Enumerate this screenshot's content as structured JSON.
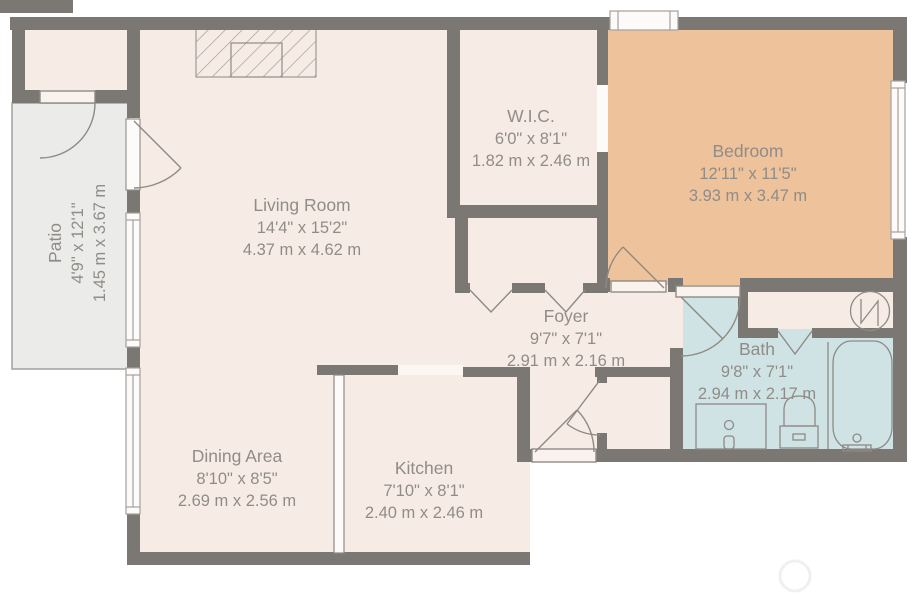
{
  "rooms": {
    "living": {
      "name": "Living Room",
      "imperial": "14'4\" x 15'2\"",
      "metric": "4.37 m x 4.62 m"
    },
    "wic": {
      "name": "W.I.C.",
      "imperial": "6'0\" x 8'1\"",
      "metric": "1.82 m x 2.46 m"
    },
    "bedroom": {
      "name": "Bedroom",
      "imperial": "12'11\" x 11'5\"",
      "metric": "3.93 m x 3.47 m"
    },
    "foyer": {
      "name": "Foyer",
      "imperial": "9'7\" x 7'1\"",
      "metric": "2.91 m x 2.16 m"
    },
    "bath": {
      "name": "Bath",
      "imperial": "9'8\" x 7'1\"",
      "metric": "2.94 m x 2.17 m"
    },
    "dining": {
      "name": "Dining Area",
      "imperial": "8'10\" x 8'5\"",
      "metric": "2.69 m x 2.56 m"
    },
    "kitchen": {
      "name": "Kitchen",
      "imperial": "7'10\" x 8'1\"",
      "metric": "2.40 m x 2.46 m"
    },
    "patio": {
      "name": "Patio",
      "imperial": "4'9\" x 12'1\"",
      "metric": "1.45 m x 3.67 m"
    }
  },
  "colors": {
    "wall": "#7b7772",
    "room_cream": "#f7ece5",
    "bedroom_fill": "#eec29b",
    "bath_fill": "#cfe3e5",
    "patio_fill": "#ebebe9",
    "line": "#8e8a85",
    "text": "#908c88",
    "window_fill": "#fcfbfa"
  },
  "icons": {
    "water_heater": "water-heater-icon",
    "bathtub": "bathtub-icon",
    "toilet": "toilet-icon",
    "sink_vanity": "sink-vanity-icon",
    "fireplace": "fireplace-icon"
  }
}
